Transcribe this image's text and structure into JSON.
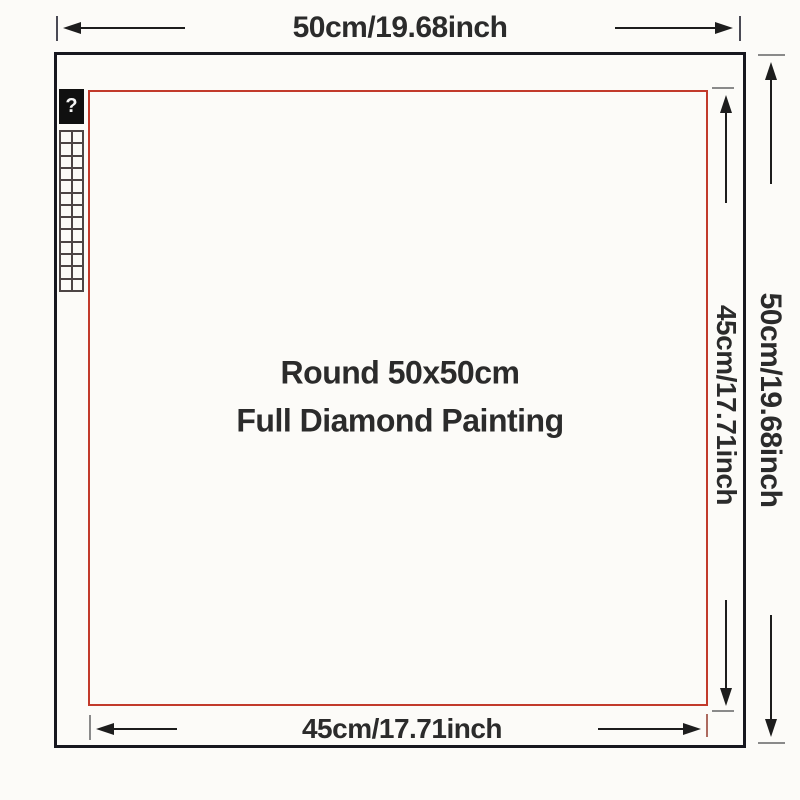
{
  "diagram": {
    "top_dimension_label": "50cm/19.68inch",
    "right_outer_dimension_label": "50cm/19.68inch",
    "right_inner_dimension_label": "45cm/17.71inch",
    "bottom_dimension_label": "45cm/17.71inch",
    "title_line1": "Round 50x50cm",
    "title_line2": "Full Diamond Painting",
    "legend": {
      "symbol": "?",
      "grid_rows": 13,
      "grid_cols": 2
    }
  },
  "colors": {
    "outer_border": "#17171f",
    "inner_border": "#c23a2b",
    "line": "#1d1d1d",
    "text": "#2b2b2b",
    "tick_gray": "#8a8a8a",
    "tick_dark": "#4a4a55",
    "tick_red": "#ad6a5f",
    "page_bg": "#fcfbf8",
    "legend_grid_line": "#4d4545"
  }
}
